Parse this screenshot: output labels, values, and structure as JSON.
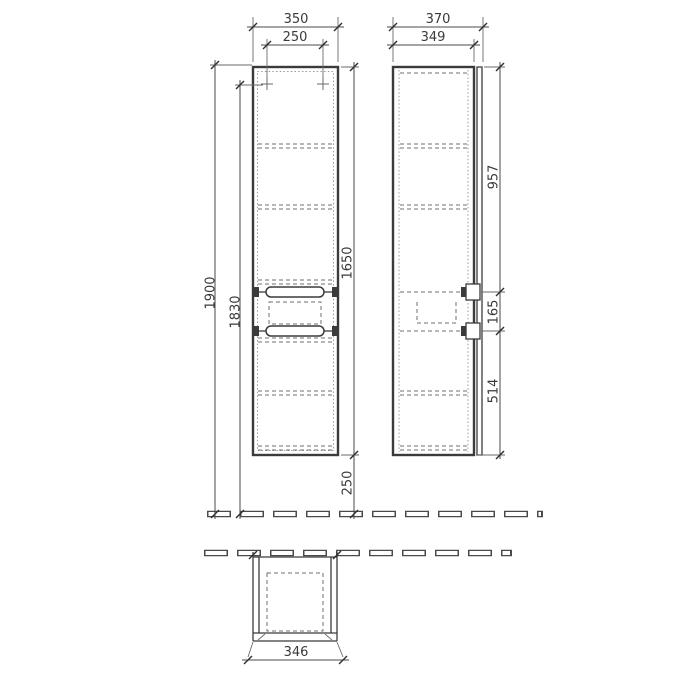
{
  "drawing": {
    "kind": "furniture technical drawing – wall-mounted tall cabinet",
    "colors": {
      "line": "#3b3b3b",
      "hidden_line": "#9a9a9a",
      "background": "#ffffff"
    },
    "dimensions": {
      "front": {
        "width_total": "350",
        "width_mounting": "250",
        "height_overall": "1900",
        "height_mounting": "1830",
        "cabinet_height": "1650",
        "floor_clearance": "250"
      },
      "side": {
        "depth_total": "370",
        "depth_body": "349",
        "top_to_handle": "957",
        "handle_spacing": "165",
        "handle_to_bottom": "514"
      },
      "plan": {
        "width": "346"
      }
    }
  }
}
